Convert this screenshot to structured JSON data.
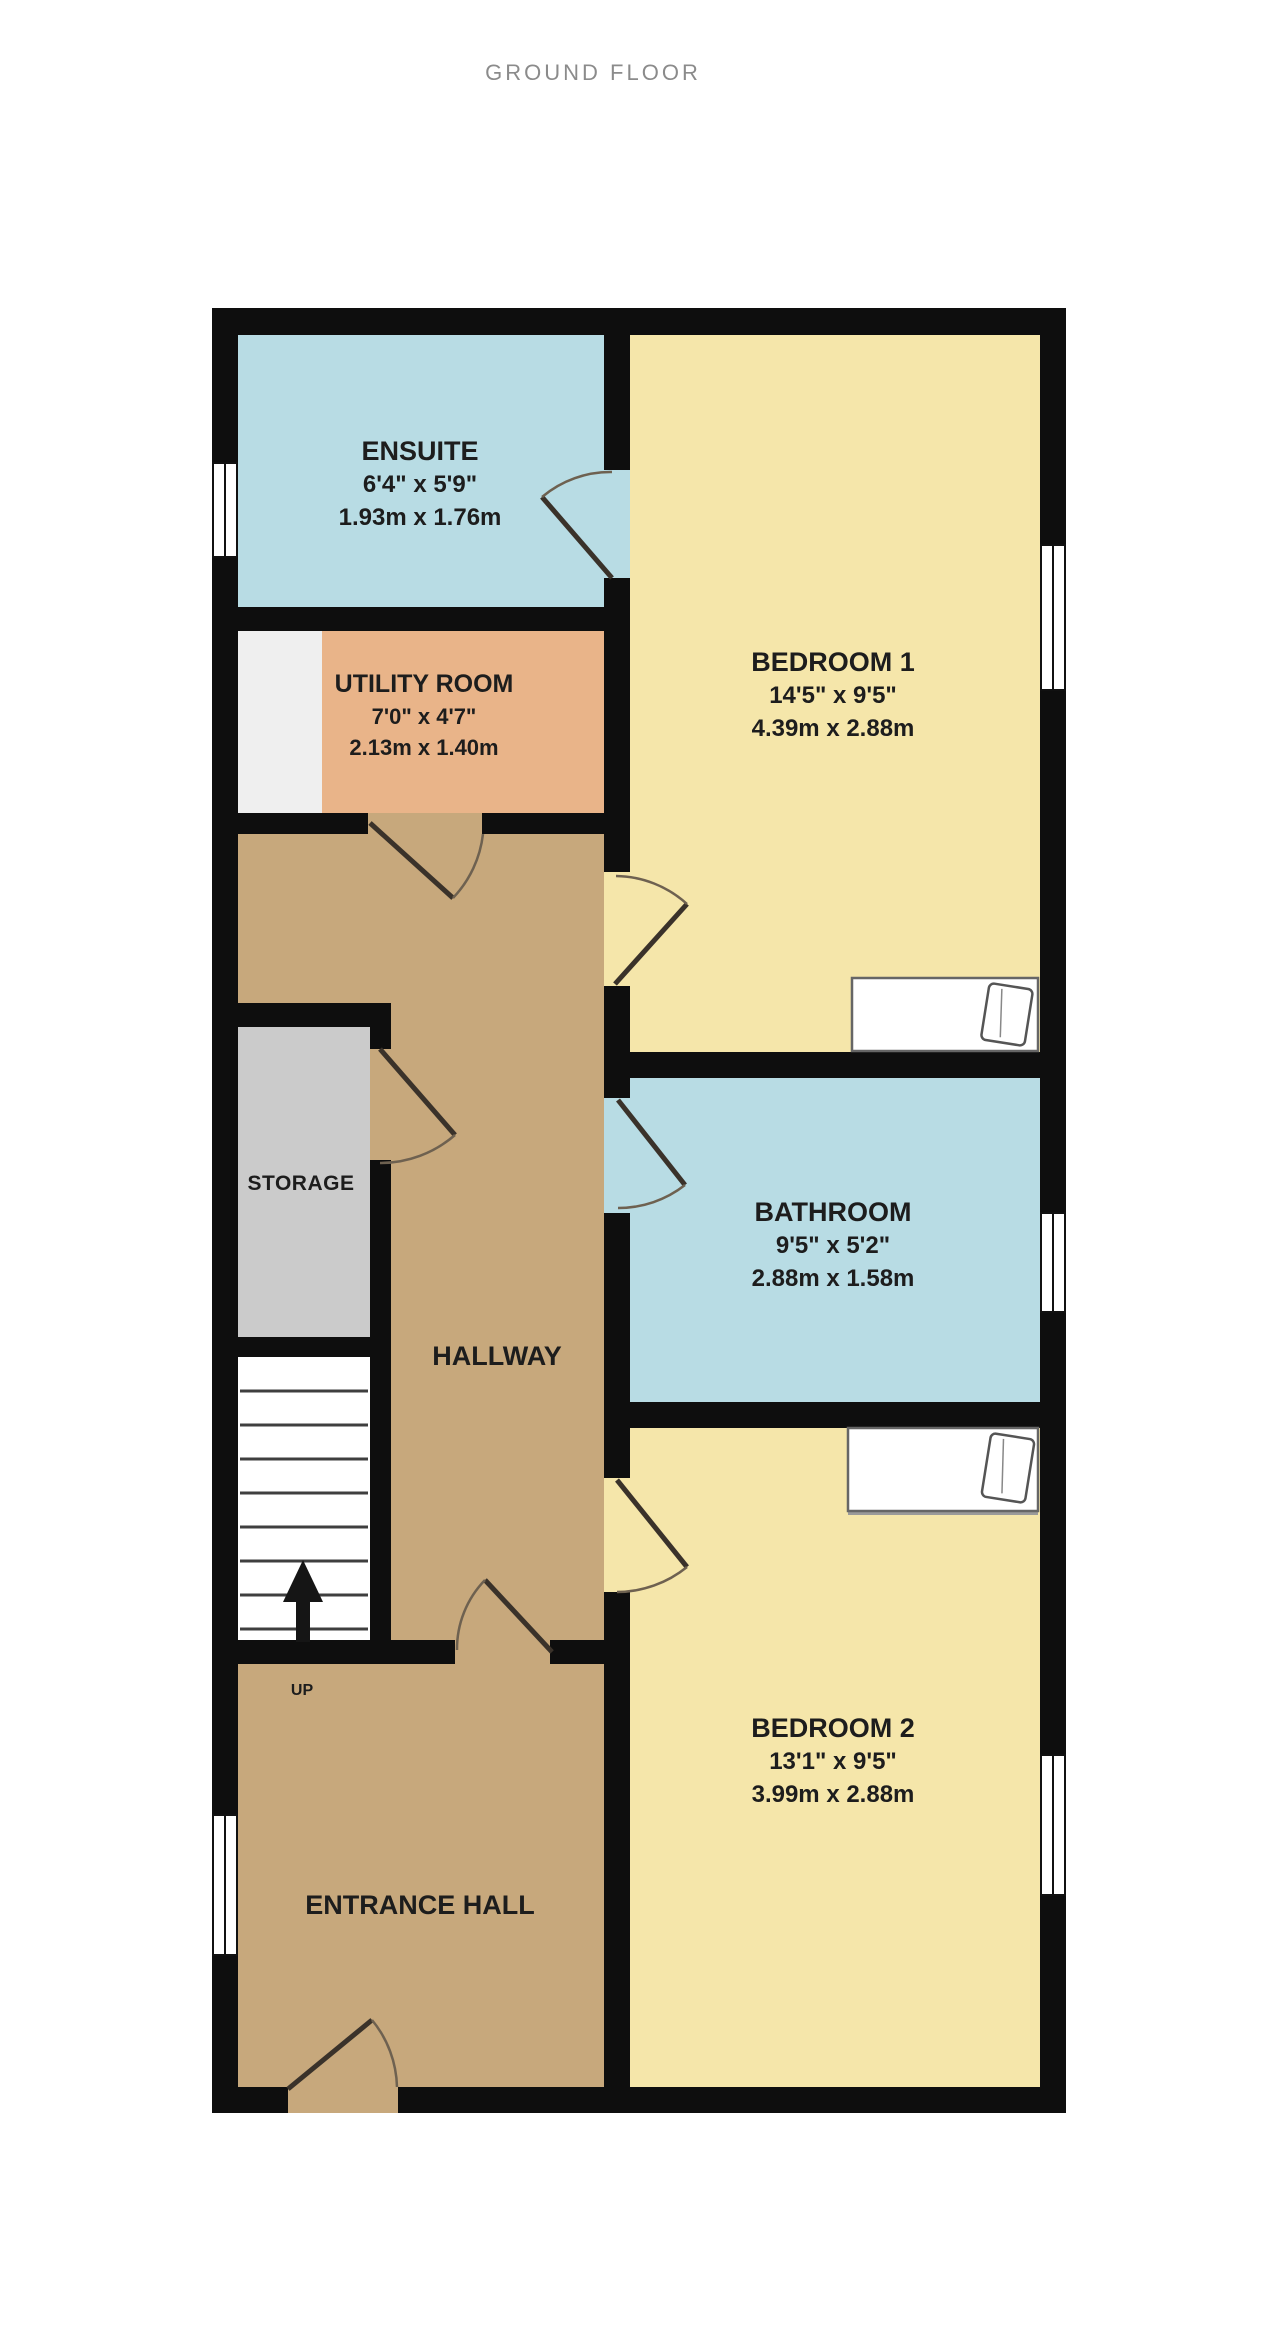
{
  "title": "GROUND FLOOR",
  "rooms": {
    "ensuite": {
      "name": "ENSUITE",
      "imperial": "6'4\"  x 5'9\"",
      "metric": "1.93m  x 1.76m"
    },
    "utility": {
      "name": "UTILITY ROOM",
      "imperial": "7'0\"  x 4'7\"",
      "metric": "2.13m  x 1.40m"
    },
    "bedroom1": {
      "name": "BEDROOM 1",
      "imperial": "14'5\"  x 9'5\"",
      "metric": "4.39m  x 2.88m"
    },
    "bathroom": {
      "name": "BATHROOM",
      "imperial": "9'5\"  x 5'2\"",
      "metric": "2.88m  x 1.58m"
    },
    "bedroom2": {
      "name": "BEDROOM 2",
      "imperial": "13'1\"  x 9'5\"",
      "metric": "3.99m  x 2.88m"
    },
    "storage": {
      "name": "STORAGE"
    },
    "hallway": {
      "name": "HALLWAY"
    },
    "entrance_hall": {
      "name": "ENTRANCE HALL"
    }
  },
  "stairs": {
    "direction_label": "UP"
  },
  "colors": {
    "wall": "#0e0e0e",
    "bedroom_yellow": "#f5e6aa",
    "bathroom_blue": "#b8dce4",
    "utility_orange": "#e9b489",
    "hallway_tan": "#c7a87c",
    "storage_grey": "#cbcbcb",
    "recess_white": "#efefef",
    "title_grey": "#8b8b8b",
    "label_black": "#1d1d1d"
  }
}
